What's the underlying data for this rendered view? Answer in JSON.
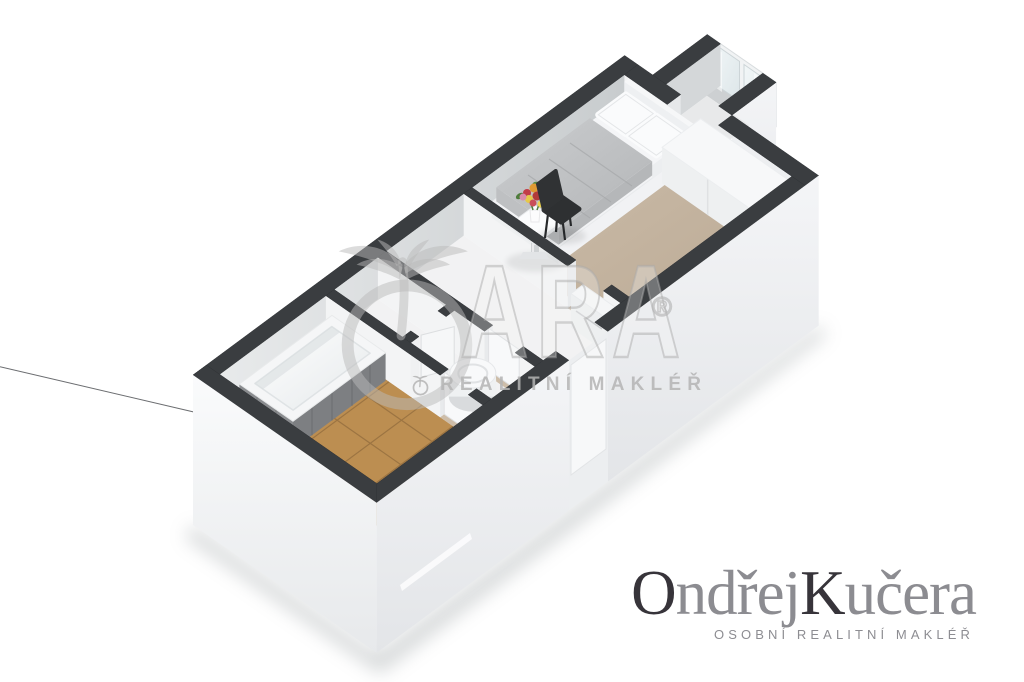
{
  "page": {
    "background": "#ffffff",
    "description": "3D axonometric floor plan render of a small apartment"
  },
  "watermark": {
    "logo_icon": "palm-tree-in-circle",
    "letters": "ARA",
    "registered_mark": "®",
    "subtitle": "REALITNÍ MAKLÉŘ",
    "color": "#bbbbbb"
  },
  "agent_logo": {
    "first_name_initial": "O",
    "first_name_rest": "ndřej",
    "last_name_initial": "K",
    "last_name_rest": "učera",
    "tagline": "OSOBNÍ REALITNÍ MAKLÉŘ",
    "initial_color": "#37343a",
    "name_color": "#8c8c91",
    "tagline_color": "#8d8d92"
  },
  "floor_plan": {
    "colors": {
      "wall_top": "#3a3d40",
      "wall_face_light": "#f3f4f5",
      "wall_face_shade": "#d6d9db",
      "floor_beige": "#c6b5a1",
      "floor_tile_terracotta": "#b6894f",
      "tile_joint": "#8f6a3c",
      "floor_white": "#f2f2f3",
      "floor_alcove": "#e8e9ea",
      "threshold_beige": "#cdbda9",
      "glass": "#e9f0f2",
      "shadow": "#9aa0a3"
    },
    "rooms": [
      {
        "name": "bathroom",
        "furniture": [
          "bathtub",
          "towel-rail"
        ]
      },
      {
        "name": "closet",
        "furniture": [
          "door"
        ]
      },
      {
        "name": "wc",
        "furniture": [
          "toilet",
          "door"
        ]
      },
      {
        "name": "hallway",
        "furniture": [
          "cabinet",
          "entrance-door"
        ]
      },
      {
        "name": "bedroom",
        "furniture": [
          "double-bed",
          "pillows",
          "desk-chair",
          "side-table",
          "flower-bouquet",
          "wardrobe"
        ]
      },
      {
        "name": "balcony-alcove",
        "furniture": [
          "window"
        ]
      }
    ]
  }
}
